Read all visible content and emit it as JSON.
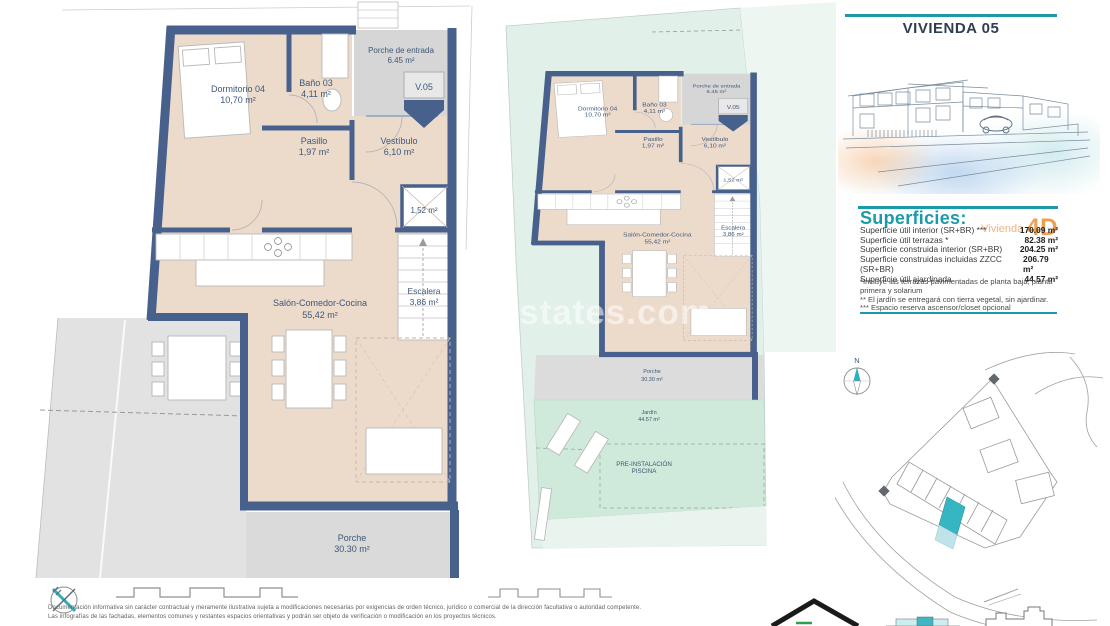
{
  "header": {
    "title": "VIVIENDA 05"
  },
  "marker": {
    "label": "V.05"
  },
  "rooms": {
    "dormitorio": {
      "name": "Dormitorio 04",
      "area": "10,70 m²"
    },
    "bano": {
      "name": "Baño 03",
      "area": "4,11 m²"
    },
    "porche_entrada": {
      "name": "Porche de entrada",
      "area": "6.45 m²"
    },
    "pasillo": {
      "name": "Pasillo",
      "area": "1,97 m²"
    },
    "vestibulo": {
      "name": "Vestíbulo",
      "area": "6,10 m²"
    },
    "trastero": {
      "area": "1,52 m²"
    },
    "salon": {
      "name": "Salón-Comedor-Cocina",
      "area": "55,42 m²"
    },
    "escalera": {
      "name": "Escalera",
      "area": "3,86 m²"
    },
    "porche": {
      "name": "Porche",
      "area": "30.30 m²"
    },
    "jardin": {
      "name": "Jardín",
      "area": "44.57 m²"
    },
    "pool_line1": "PRE-INSTALACIÓN",
    "pool_line2": "PISCINA"
  },
  "superficies": {
    "title": "Superficies:",
    "vivienda_label": "Vivienda",
    "vivienda_code": "4D",
    "rows": [
      {
        "label": "Superficie útil interior (SR+BR) ***",
        "value": "170.09 m²"
      },
      {
        "label": "Superficie útil terrazas *",
        "value": "82.38 m²"
      },
      {
        "label": "Superficie construida interior (SR+BR)",
        "value": "204.25 m²"
      },
      {
        "label": "Superficie construidas incluidas ZZCC (SR+BR)",
        "value": "206.79 m²"
      },
      {
        "label": "Superficie útil ajardinada",
        "value": "44.57 m²"
      }
    ],
    "notes": [
      "*Incluye las terrazas pavimentadas de planta baja, planta primera y solarium",
      "** El jardín se entregará con tierra vegetal, sin ajardinar.",
      "*** Espacio reserva ascensor/closet opcional"
    ]
  },
  "compass": {
    "north": "N"
  },
  "watermark": {
    "text": "restates.com"
  },
  "disclaimer": {
    "line1": "Documentación informativa sin carácter contractual y meramente ilustrativa sujeta a modificaciones necesarias por exigencias de orden técnico, jurídico o comercial de la dirección facultativa o autoridad competente.",
    "line2": "Las infografías de las fachadas, elementos comunes y restantes espacios orientativas y podrán ser objeto de verificación o modificación en los proyectos técnicos."
  },
  "colors": {
    "accent_teal": "#1b9aa9",
    "accent_orange": "#ee9f50",
    "wall_navy": "#47618c",
    "floor_beige": "#ecdacb",
    "porch_gray": "#d9d9d9",
    "garden_green": "#cfe9da",
    "site_highlight": "#35b6c2"
  }
}
